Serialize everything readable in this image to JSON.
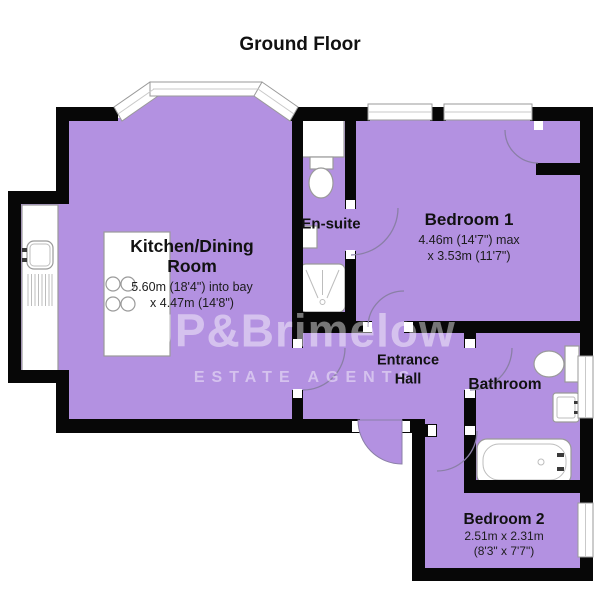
{
  "title": "Ground Floor",
  "watermark": {
    "brand": "JP&Brimelow",
    "tagline": "ESTATE AGENTS"
  },
  "rooms": {
    "kitchen": {
      "name_line1": "Kitchen/Dining",
      "name_line2": "Room",
      "dims_line1": "5.60m (18'4\") into bay",
      "dims_line2": "x 4.47m (14'8\")"
    },
    "ensuite": {
      "name": "En-suite"
    },
    "bedroom1": {
      "name": "Bedroom 1",
      "dims_line1": "4.46m (14'7\") max",
      "dims_line2": "x 3.53m (11'7\")"
    },
    "hall": {
      "name_line1": "Entrance",
      "name_line2": "Hall"
    },
    "bathroom": {
      "name": "Bathroom"
    },
    "bedroom2": {
      "name": "Bedroom 2",
      "dims_line1": "2.51m x 2.31m",
      "dims_line2": "(8'3\" x 7'7\")"
    }
  },
  "colors": {
    "floor_fill": "#b391e1",
    "wall": "#070707",
    "fixture_outline": "#9a9a9a",
    "door_arc": "#8a7fa6",
    "watermark_text": "rgba(255,255,255,0.45)",
    "label_text": "#111111"
  }
}
